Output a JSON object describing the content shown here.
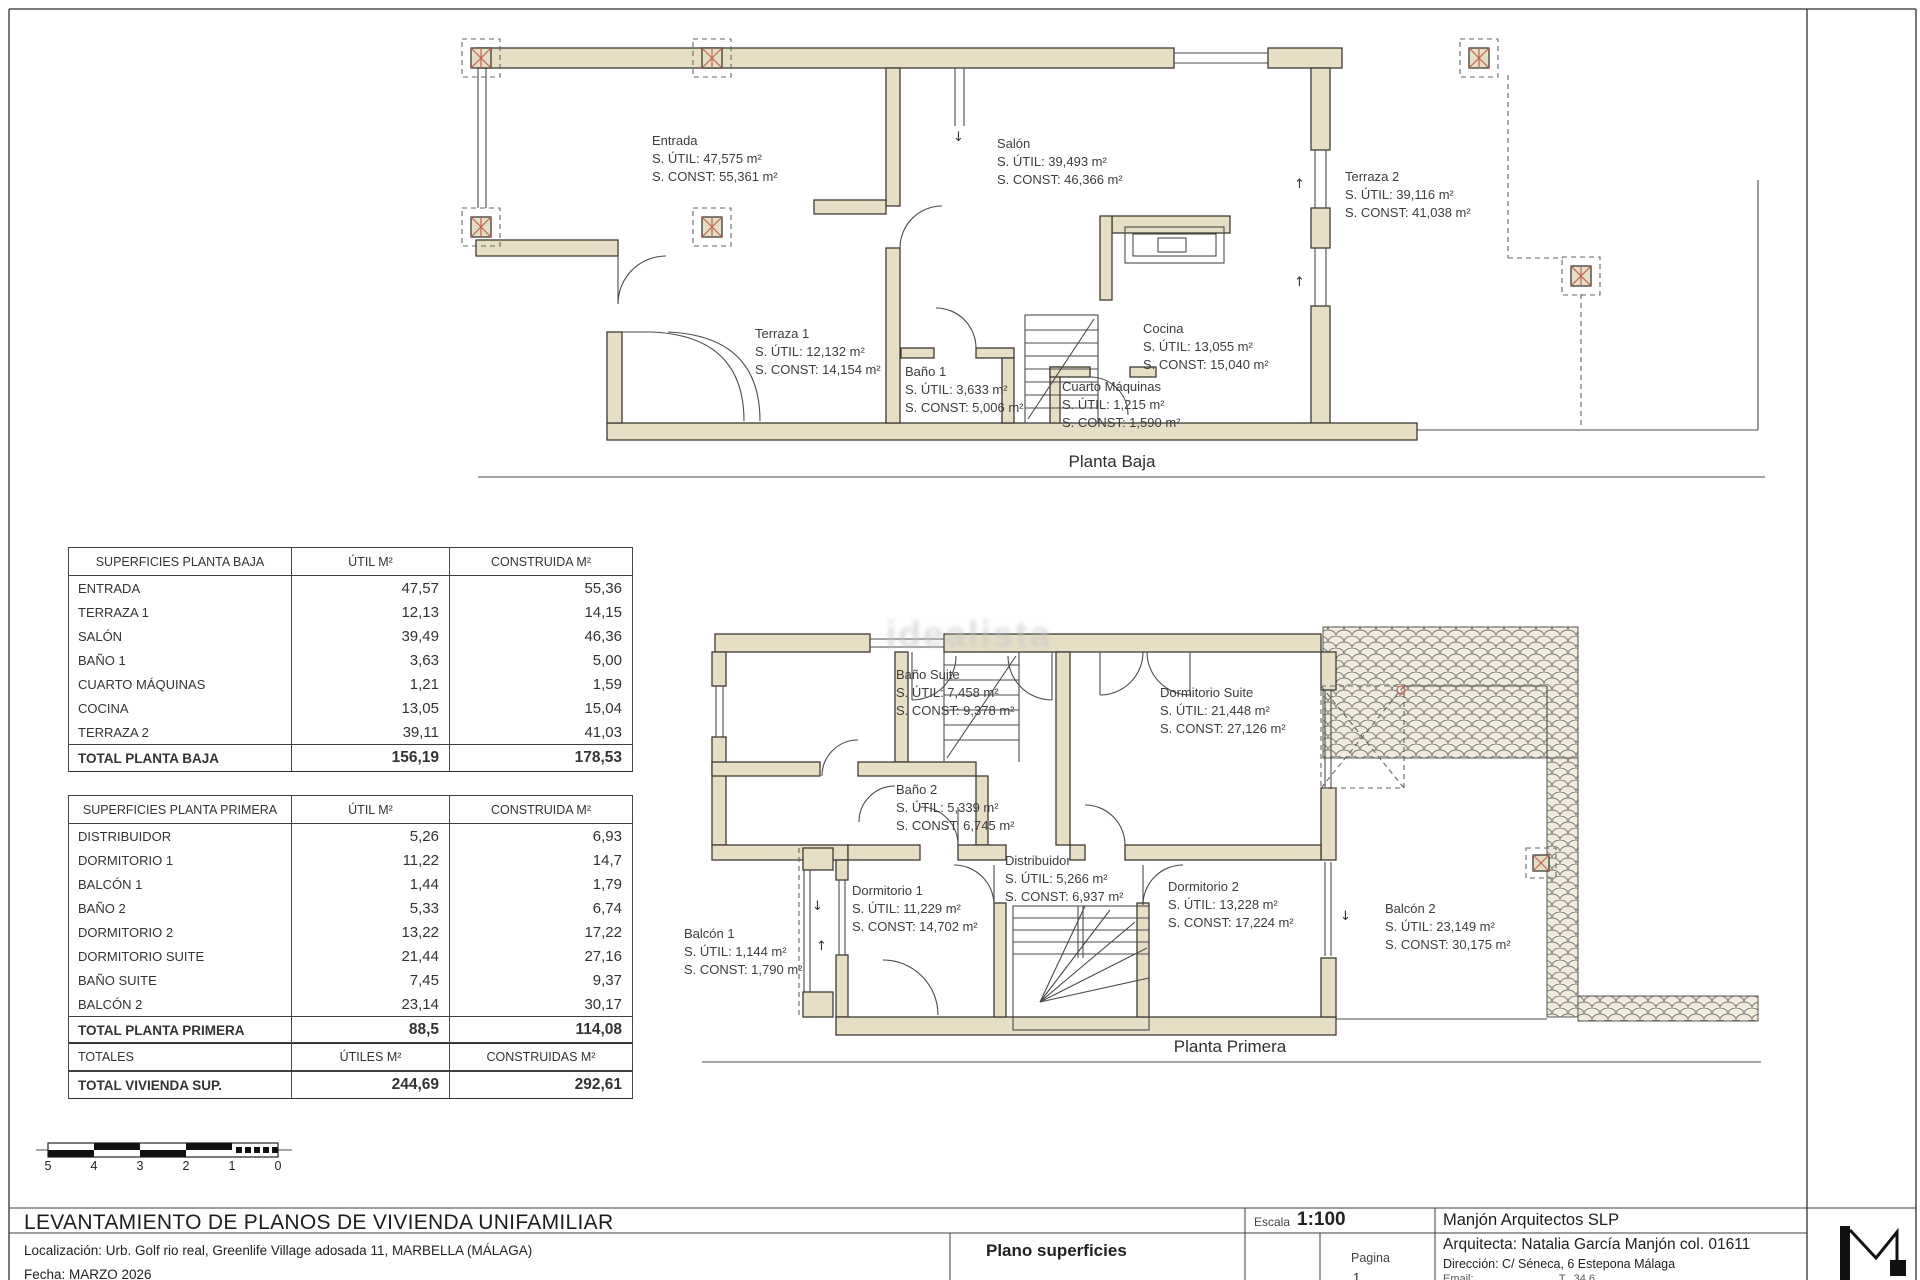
{
  "watermark": "idealista",
  "plans": {
    "baja": {
      "title": "Planta Baja",
      "rooms": [
        {
          "name": "Entrada",
          "util": "S. ÚTIL: 47,575 m²",
          "constr": "S. CONST: 55,361 m²"
        },
        {
          "name": "Salón",
          "util": "S. ÚTIL: 39,493 m²",
          "constr": "S. CONST: 46,366 m²"
        },
        {
          "name": "Terraza 2",
          "util": "S. ÚTIL: 39,116 m²",
          "constr": "S. CONST: 41,038 m²"
        },
        {
          "name": "Terraza 1",
          "util": "S. ÚTIL: 12,132 m²",
          "constr": "S. CONST: 14,154 m²"
        },
        {
          "name": "Baño 1",
          "util": "S. ÚTIL: 3,633 m²",
          "constr": "S. CONST: 5,006 m²"
        },
        {
          "name": "Cuarto Máquinas",
          "util": "S. ÚTIL: 1,215 m²",
          "constr": "S. CONST: 1,590 m²"
        },
        {
          "name": "Cocina",
          "util": "S. ÚTIL: 13,055 m²",
          "constr": "S. CONST: 15,040 m²"
        }
      ]
    },
    "primera": {
      "title": "Planta Primera",
      "rooms": [
        {
          "name": "Baño Suite",
          "util": "S. ÚTIL: 7,458 m²",
          "constr": "S. CONST: 9,378 m²"
        },
        {
          "name": "Dormitorio Suite",
          "util": "S. ÚTIL: 21,448 m²",
          "constr": "S. CONST: 27,126 m²"
        },
        {
          "name": "Baño 2",
          "util": "S. ÚTIL: 5,339 m²",
          "constr": "S. CONST: 6,745 m²"
        },
        {
          "name": "Distribuidor",
          "util": "S. ÚTIL: 5,266 m²",
          "constr": "S. CONST: 6,937 m²"
        },
        {
          "name": "Dormitorio 1",
          "util": "S. ÚTIL: 11,229 m²",
          "constr": "S. CONST: 14,702 m²"
        },
        {
          "name": "Balcón 1",
          "util": "S. ÚTIL: 1,144 m²",
          "constr": "S. CONST: 1,790 m²"
        },
        {
          "name": "Dormitorio 2",
          "util": "S. ÚTIL: 13,228 m²",
          "constr": "S. CONST: 17,224 m²"
        },
        {
          "name": "Balcón 2",
          "util": "S. ÚTIL: 23,149 m²",
          "constr": "S. CONST: 30,175 m²"
        }
      ]
    }
  },
  "tables": {
    "baja": {
      "headers": [
        "SUPERFICIES PLANTA BAJA",
        "ÚTIL M²",
        "CONSTRUIDA M²"
      ],
      "rows": [
        [
          "ENTRADA",
          "47,57",
          "55,36"
        ],
        [
          "TERRAZA 1",
          "12,13",
          "14,15"
        ],
        [
          "SALÓN",
          "39,49",
          "46,36"
        ],
        [
          "BAÑO 1",
          "3,63",
          "5,00"
        ],
        [
          "CUARTO MÁQUINAS",
          "1,21",
          "1,59"
        ],
        [
          "COCINA",
          "13,05",
          "15,04"
        ],
        [
          "TERRAZA 2",
          "39,11",
          "41,03"
        ]
      ],
      "total": [
        "TOTAL PLANTA BAJA",
        "156,19",
        "178,53"
      ]
    },
    "primera": {
      "headers": [
        "SUPERFICIES PLANTA PRIMERA",
        "ÚTIL M²",
        "CONSTRUIDA M²"
      ],
      "rows": [
        [
          "DISTRIBUIDOR",
          "5,26",
          "6,93"
        ],
        [
          "DORMITORIO 1",
          "11,22",
          "14,7"
        ],
        [
          "BALCÓN 1",
          "1,44",
          "1,79"
        ],
        [
          "BAÑO 2",
          "5,33",
          "6,74"
        ],
        [
          "DORMITORIO 2",
          "13,22",
          "17,22"
        ],
        [
          "DORMITORIO SUITE",
          "21,44",
          "27,16"
        ],
        [
          "BAÑO SUITE",
          "7,45",
          "9,37"
        ],
        [
          "BALCÓN 2",
          "23,14",
          "30,17"
        ]
      ],
      "total": [
        "TOTAL PLANTA PRIMERA",
        "88,5",
        "114,08"
      ]
    },
    "totales": {
      "headers": [
        "TOTALES",
        "ÚTILES M²",
        "CONSTRUIDAS M²"
      ],
      "rows": [],
      "total": [
        "TOTAL VIVIENDA SUP.",
        "244,69",
        "292,61"
      ]
    }
  },
  "scale_bar": {
    "labels": [
      "5",
      "4",
      "3",
      "2",
      "1",
      "0"
    ]
  },
  "title_block": {
    "project_title": "LEVANTAMIENTO DE PLANOS DE VIVIENDA UNIFAMILIAR",
    "location": "Localización:  Urb. Golf rio real, Greenlife Village adosada 11, MARBELLA (MÁLAGA)",
    "date": "Fecha: MARZO 2026",
    "plan_name": "Plano superficies",
    "scale_label": "Escala",
    "scale_value": "1:100",
    "page_label": "Pagina",
    "page_number": "1",
    "firm": "Manjón Arquitectos SLP",
    "architect": "Arquitecta: Natalia García Manjón col. 01611",
    "address": "Dirección: C/ Séneca, 6 Estepona Málaga",
    "contact": "Email: ..........................  T. .34 6.. .. .. .."
  }
}
